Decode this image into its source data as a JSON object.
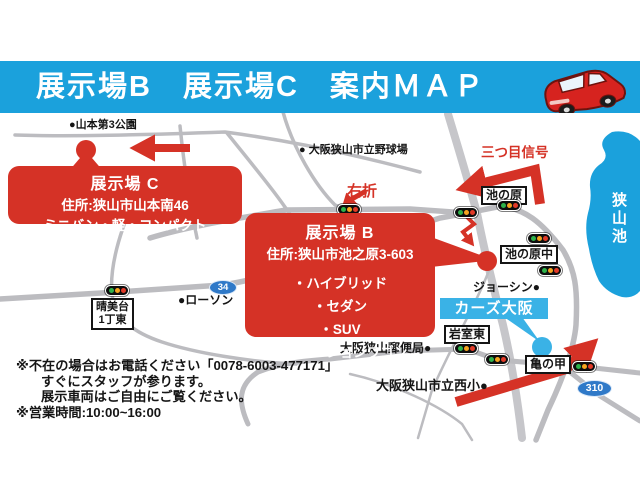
{
  "header": {
    "title": "展示場B　展示場C　案内ＭＡＰ"
  },
  "callouts": {
    "site_c": {
      "title": "展示場 C",
      "address": "住所:狭山市山本南46",
      "vehicles": "ミニバン・軽・コンパクト"
    },
    "site_b": {
      "title": "展示場 B",
      "address": "住所:狭山市池之原3-603",
      "vehicles": [
        "・ハイブリッド",
        "・セダン",
        "・SUV",
        "・ステーションワゴン"
      ]
    }
  },
  "map": {
    "landmarks": {
      "park": "●山本第3公園",
      "baseball": "● 大阪狭山市立野球場",
      "joshin": "ジョーシン●",
      "post_office": "大阪狭山郵便局●",
      "elementary": "大阪狭山市立西小●",
      "lawson": "●ローソン",
      "lake": "狭山池"
    },
    "intersections": {
      "ikenohara": "池の原",
      "ikenoharanaka": "池の原中",
      "iwamurohigashi": "岩室東",
      "kamenoko": "亀の甲",
      "harumidai_1": "晴美台",
      "harumidai_2": "1丁東"
    },
    "directions": {
      "migisetsu": "右折",
      "mitsume": "三つ目信号"
    },
    "route_badges": {
      "r34": "34",
      "r310": "310"
    },
    "dealer": "カーズ大阪"
  },
  "notes": {
    "line1": "※不在の場合はお電話ください「0078-6003-477171」",
    "line2": "すぐにスタッフが参ります。",
    "line3": "展示車両はご自由にご覧ください。",
    "line4": "※営業時間:10:00~16:00"
  },
  "colors": {
    "header_blue": "#1ba1dc",
    "lake_blue": "#1ba1dc",
    "dealer_blue": "#3ab2e6",
    "badge_blue": "#2f79c8",
    "accent_red": "#d53226",
    "road_gray": "#b9b9bd"
  }
}
